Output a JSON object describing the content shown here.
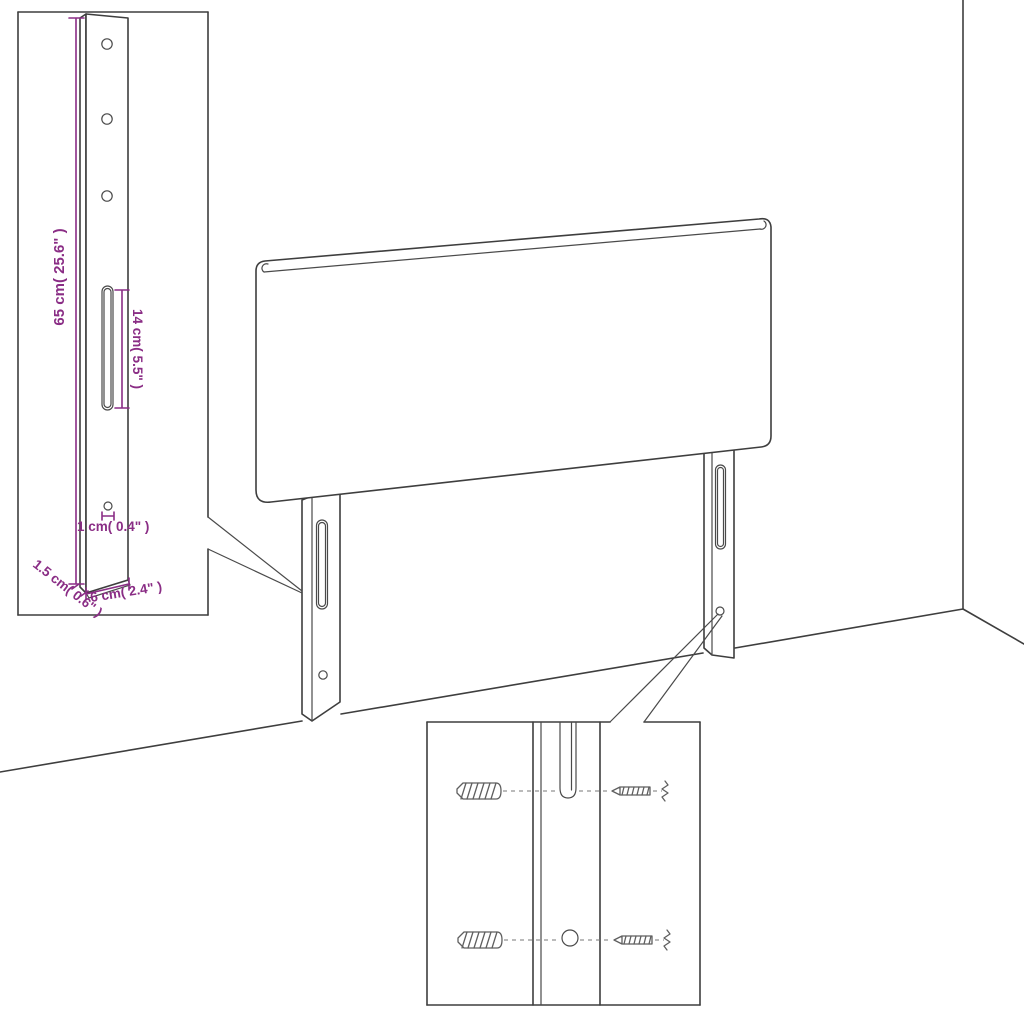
{
  "title": "Headboard with legs – assembly dimension diagram",
  "colors": {
    "background": "#ffffff",
    "line": "#3e3e3e",
    "dimension": "#8a2d85",
    "screw": "#5f5f5f"
  },
  "leg_detail": {
    "name": "leg bracket detail inset",
    "dimensions": [
      {
        "id": "bracket-height",
        "label": "65 cm( 25.6\" )"
      },
      {
        "id": "slot-length",
        "label": "14 cm( 5.5\" )"
      },
      {
        "id": "hole-diameter",
        "label": "1 cm( 0.4\" )"
      },
      {
        "id": "bracket-thickness",
        "label": "1.5 cm( 0.6\" )"
      },
      {
        "id": "bracket-width",
        "label": "6 cm( 2.4\" )"
      }
    ],
    "features": {
      "round_holes_top": 3,
      "long_slot": 1,
      "small_hole_bottom": 1
    }
  },
  "mounting_detail": {
    "name": "screw mounting detail inset",
    "screws": 4,
    "features": {
      "slot": 1,
      "round_hole": 1
    }
  },
  "scene": {
    "panel": "upholstered headboard panel",
    "legs": 2,
    "room": "wall corner and floor lines"
  }
}
